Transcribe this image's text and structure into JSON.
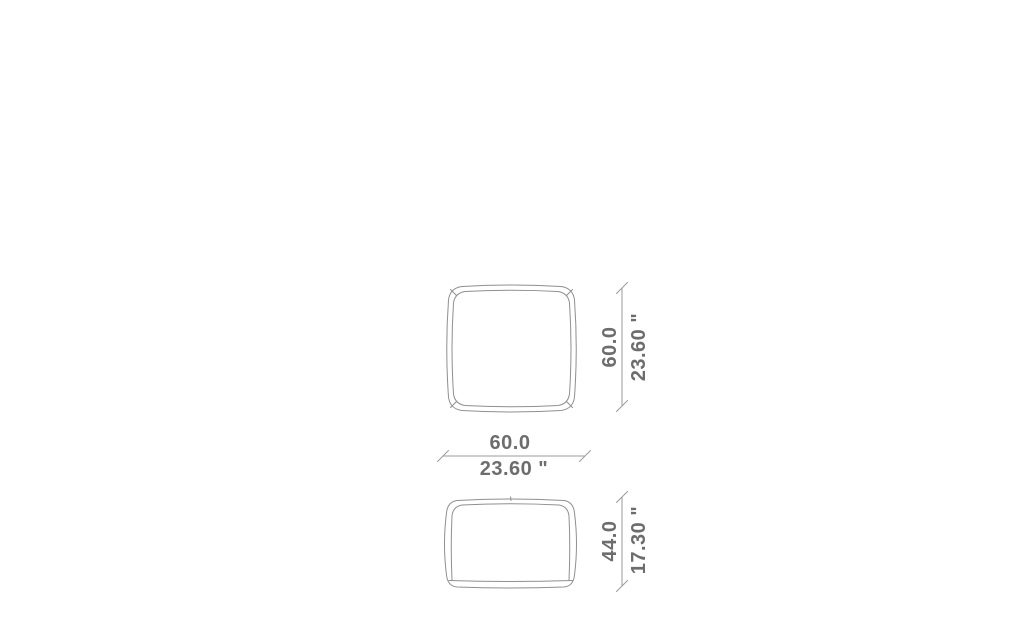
{
  "dimensions": {
    "depth": {
      "cm": "60.0",
      "inch": "23.60 \""
    },
    "width": {
      "cm": "60.0",
      "inch": "23.60 \""
    },
    "height": {
      "cm": "44.0",
      "inch": "17.30 \""
    }
  },
  "colors": {
    "dimension_text": "#6d6d6d",
    "dimension_line": "#9b9b9b",
    "drawing_line": "#8f8f8f",
    "page_bg": "#ffffff"
  }
}
